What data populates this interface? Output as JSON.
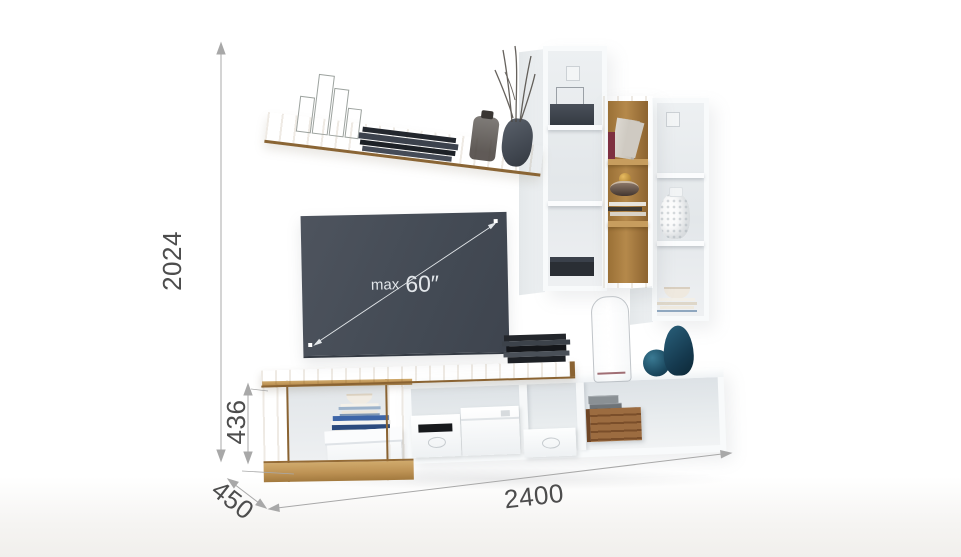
{
  "scene": {
    "title": "wall-unit-dimension-render"
  },
  "tv": {
    "label_prefix": "max",
    "label_size": "60″"
  },
  "dimensions": {
    "total_height_mm": "2024",
    "stand_height_mm": "436",
    "depth_mm": "450",
    "total_width_mm": "2400"
  },
  "colors": {
    "wood": "#bd9254",
    "wood_dark": "#8c6330",
    "white_furniture": "#f8fafb",
    "furniture_interior": "#e7ebee",
    "tv_screen": "#444b55",
    "dimension_line": "#a8a8a8",
    "dimension_text": "#4d4d4d",
    "vase_blue": "#1d4f68",
    "crate_wood": "#8a5c35"
  }
}
